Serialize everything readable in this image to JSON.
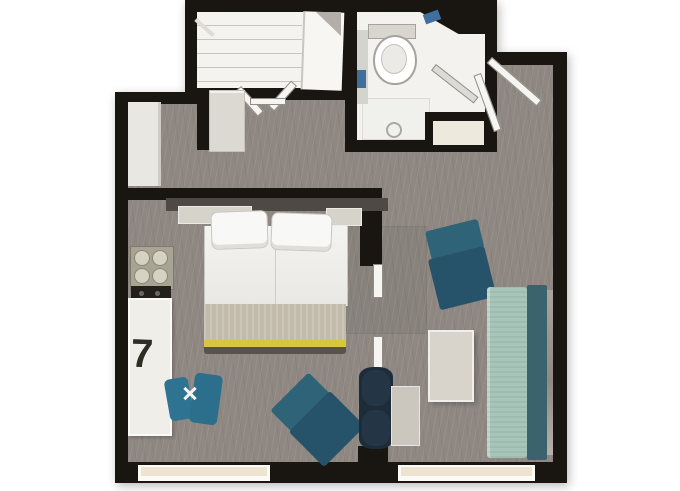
{
  "labels": {
    "unit_number": "7"
  },
  "palette": {
    "wall": "#191511",
    "carpet": "#8f8882",
    "closet_interior": "#f4f3f0",
    "bath_interior": "#f3f2ef",
    "window_glass": "#ece4cf",
    "window_frame": "#fbfaf6",
    "bed_duvet": "#f1f0ed",
    "bed_blanket": "#c8c1b1",
    "bed_stripe": "#d9c53e",
    "headboard": "#4e4a43",
    "shelf": "#d6d3cb",
    "counter": "#f0eee8",
    "stove": "#a8a493",
    "burner": "#d6d2c1",
    "teal_dark": "#27536a",
    "teal_mid": "#2f6378",
    "teal_stool": "#2e7492",
    "sofa_seat": "#a3c2b6",
    "sofa_back": "#3a636d",
    "table": "#d8d4cc",
    "tv_unit": "#1d2c39",
    "fixture_gray": "#d5d3cd",
    "towel_blue": "#3f6f9f",
    "door_leaf": "#f6f5f2",
    "label_ink": "#2f2c26"
  },
  "rooms": [
    "entry-hall",
    "closet",
    "bathroom",
    "sleeping-area",
    "kitchenette",
    "living-area"
  ],
  "furniture": [
    {
      "name": "wardrobe-with-shelves",
      "room": "closet"
    },
    {
      "name": "bifold-closet-doors",
      "room": "closet"
    },
    {
      "name": "toilet",
      "room": "bathroom"
    },
    {
      "name": "shower-with-glass-door",
      "room": "bathroom"
    },
    {
      "name": "blue-towels",
      "room": "bathroom"
    },
    {
      "name": "storage-niche",
      "room": "bathroom"
    },
    {
      "name": "entry-door-leaves",
      "room": "entry-hall"
    },
    {
      "name": "tall-cabinet-fridge",
      "room": "entry-hall"
    },
    {
      "name": "console-shelf",
      "room": "entry-hall"
    },
    {
      "name": "double-bed-with-pillows",
      "room": "sleeping-area"
    },
    {
      "name": "headboard-shelves",
      "room": "sleeping-area"
    },
    {
      "name": "cooktop-four-burners",
      "room": "kitchenette"
    },
    {
      "name": "counter-desk",
      "room": "kitchenette"
    },
    {
      "name": "teal-butterfly-stool",
      "room": "kitchenette"
    },
    {
      "name": "teal-lounge-chair-upper",
      "room": "living-area"
    },
    {
      "name": "teal-lounge-chair-lower",
      "room": "living-area"
    },
    {
      "name": "side-table",
      "room": "living-area"
    },
    {
      "name": "tv-partition-unit",
      "room": "living-area"
    },
    {
      "name": "sofa-daybed",
      "room": "living-area"
    },
    {
      "name": "window",
      "room": "living-area"
    },
    {
      "name": "window",
      "room": "sleeping-area"
    }
  ]
}
